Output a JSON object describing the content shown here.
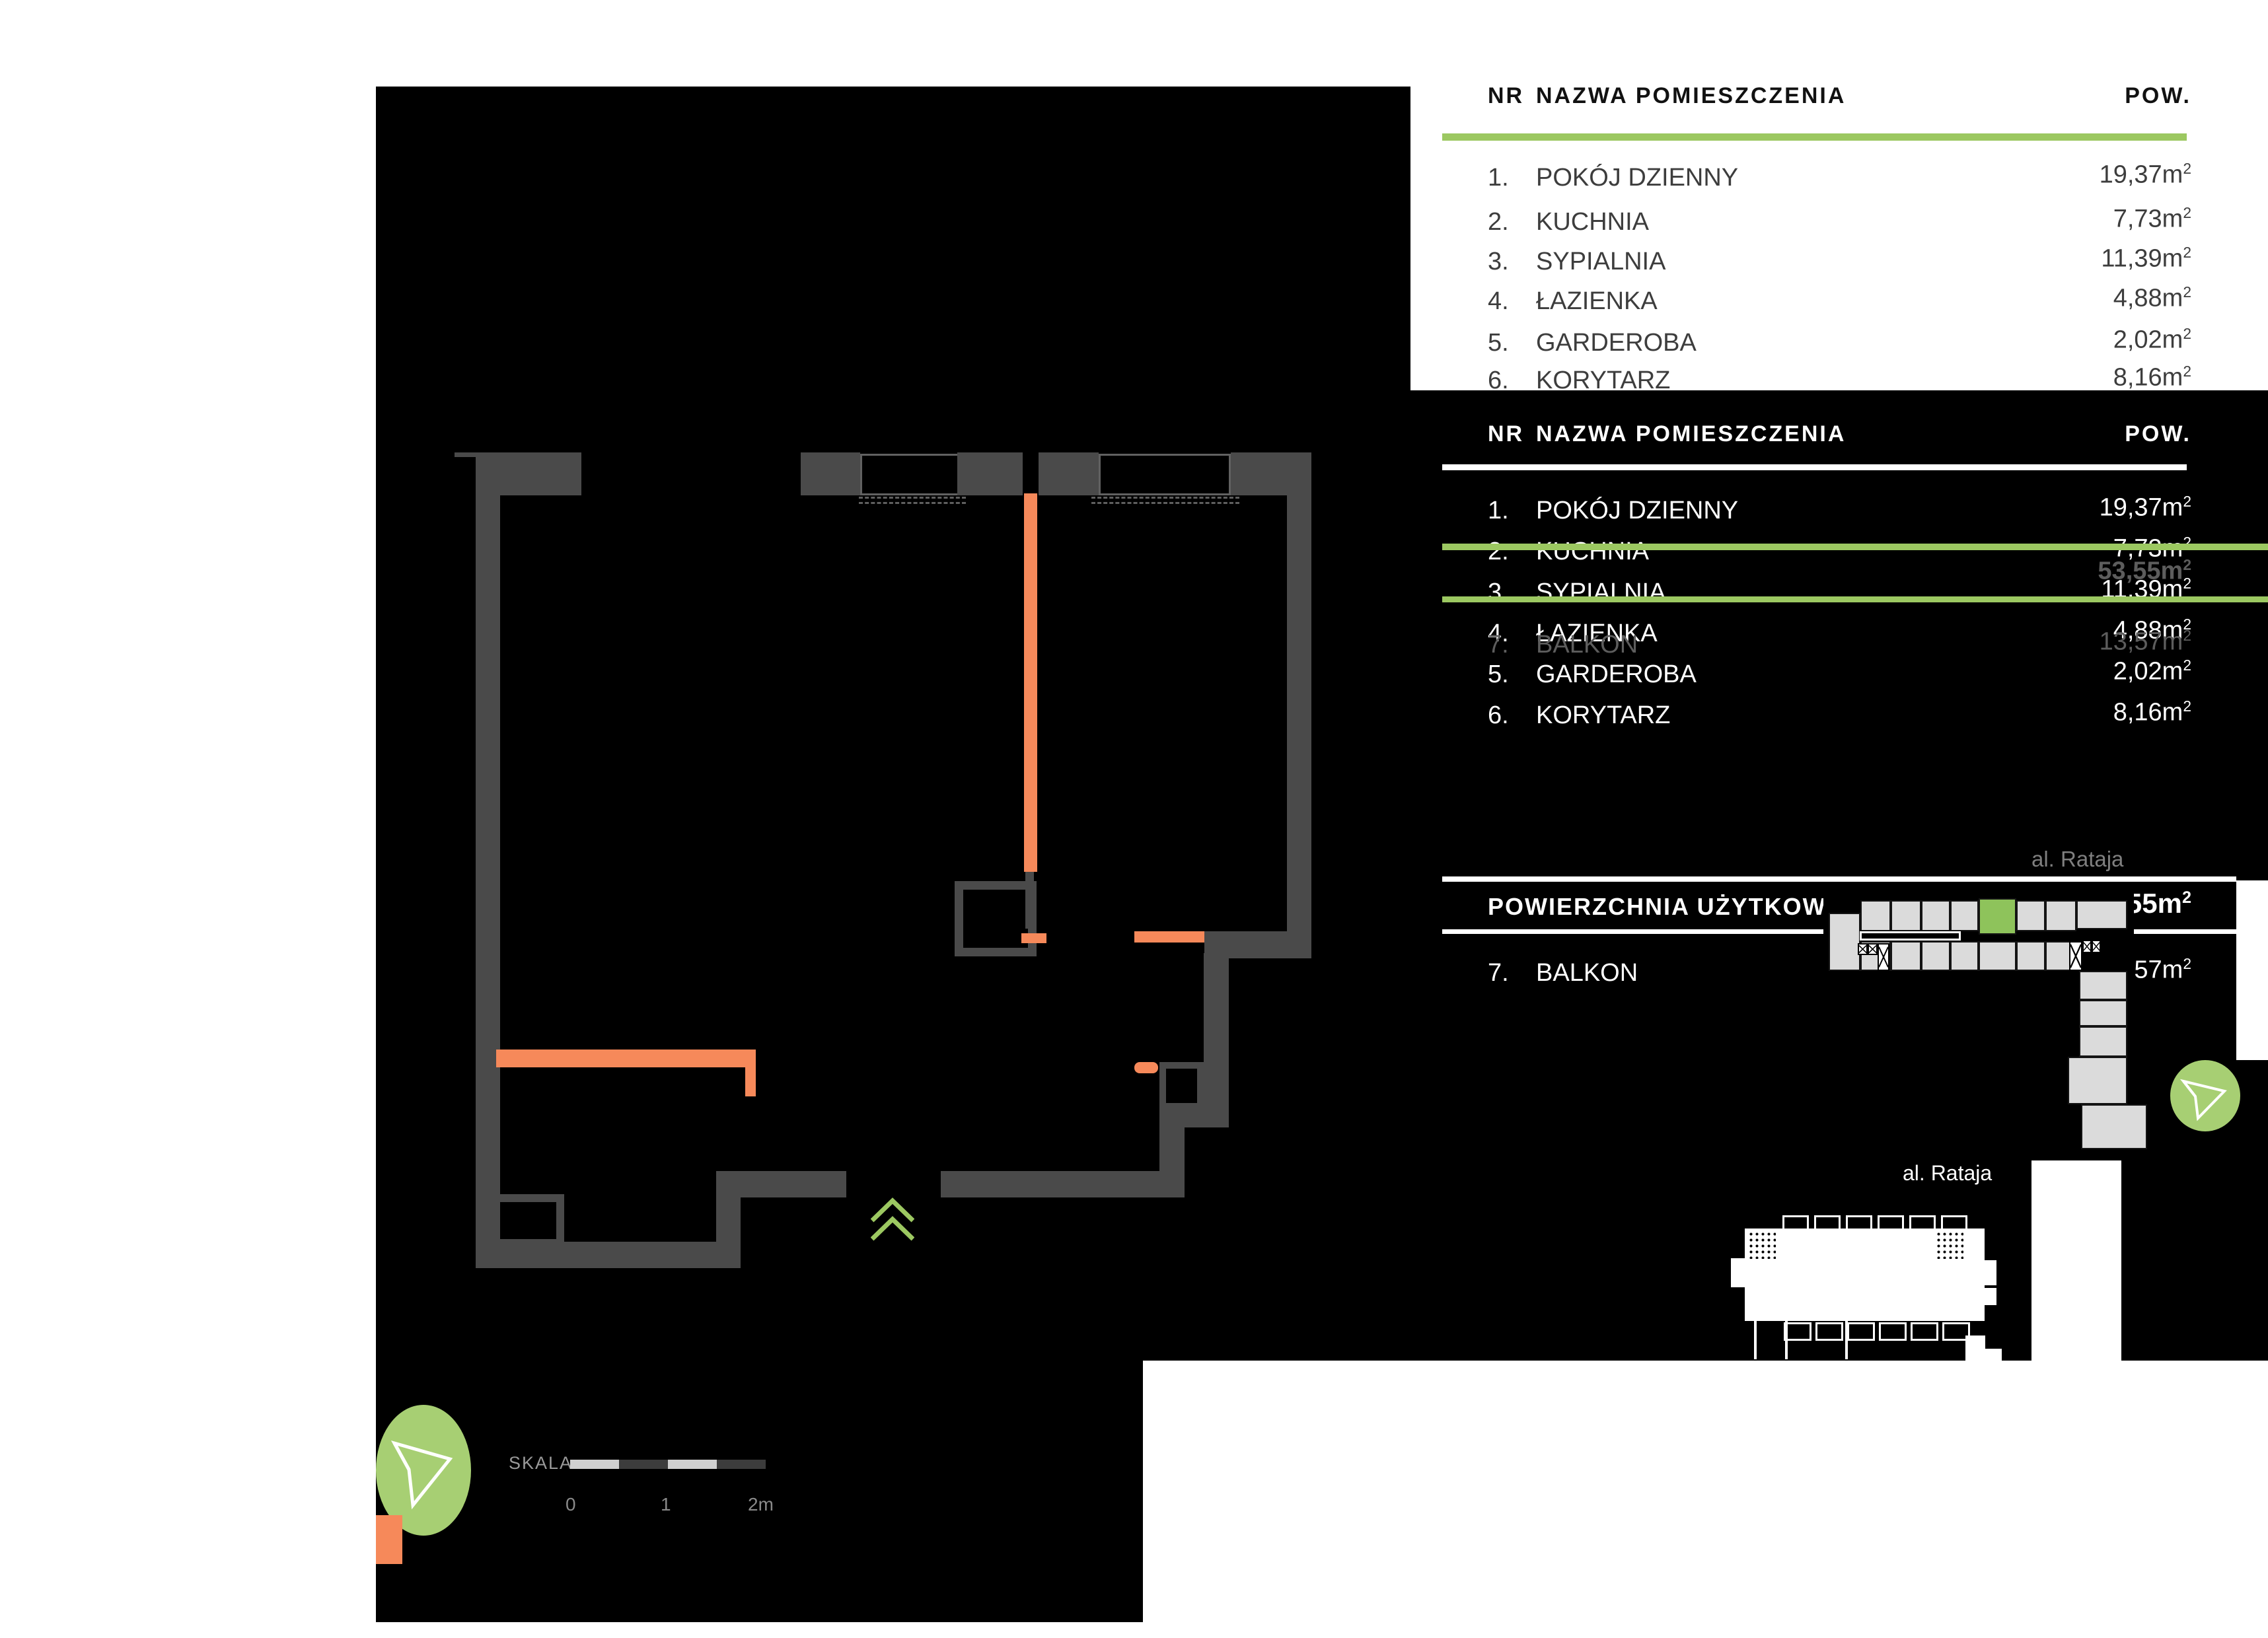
{
  "header": {
    "nr": "NR",
    "name": "NAZWA POMIESZCZENIA",
    "pow": "POW."
  },
  "rooms": [
    {
      "no": "1.",
      "name": "POKÓJ DZIENNY",
      "area": "19,37m",
      "sup": "2"
    },
    {
      "no": "2.",
      "name": "KUCHNIA",
      "area": "7,73m",
      "sup": "2"
    },
    {
      "no": "3.",
      "name": "SYPIALNIA",
      "area": "11,39m",
      "sup": "2"
    },
    {
      "no": "4.",
      "name": "ŁAZIENKA",
      "area": "4,88m",
      "sup": "2"
    },
    {
      "no": "5.",
      "name": "GARDEROBA",
      "area": "2,02m",
      "sup": "2"
    },
    {
      "no": "6.",
      "name": "KORYTARZ",
      "area": "8,16m",
      "sup": "2"
    }
  ],
  "summary": {
    "title": "POWIERZCHNIA UŻYTKOWA",
    "total": "53,55m",
    "total_sup": "2",
    "balkon": {
      "no": "7.",
      "name": "BALKON",
      "area": "13,57m",
      "sup": "2"
    }
  },
  "labels": {
    "street": "al. Rataja",
    "scale": "SKALA",
    "tick0": "0",
    "tick1": "1",
    "tick2": "2m"
  },
  "colors": {
    "accent_green": "#9CC861",
    "compass_green": "#A7CF73",
    "unit_green": "#8EC35B",
    "wall_gray": "#4a4a4a",
    "accent_orange": "#F6895A"
  }
}
